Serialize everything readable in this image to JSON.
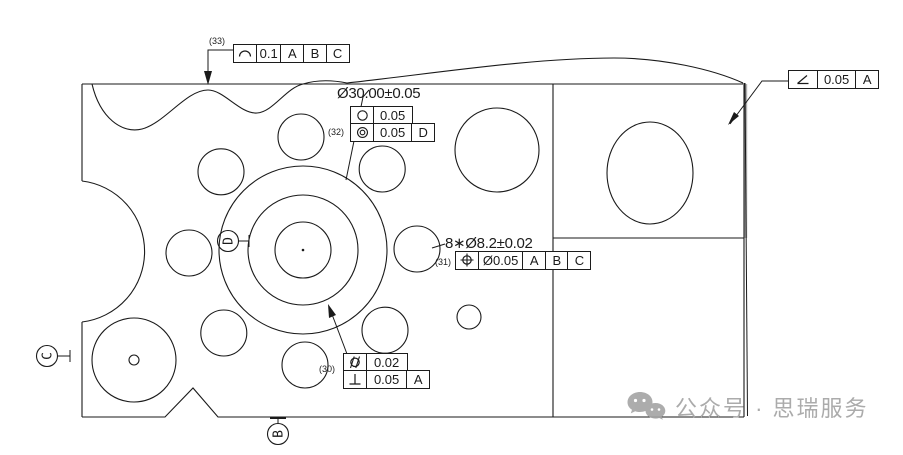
{
  "callouts": {
    "profile_line": {
      "label": "(33)",
      "symbol": "profile-of-a-line",
      "tolerance": "0.1",
      "datum1": "A",
      "datum2": "B",
      "datum3": "C"
    },
    "hub": {
      "label": "(32)",
      "dimension": "Ø30.00±0.05",
      "circularity": {
        "symbol": "circularity",
        "tolerance": "0.05"
      },
      "concentricity": {
        "symbol": "concentricity",
        "tolerance": "0.05",
        "datum": "D"
      }
    },
    "holes": {
      "label": "(31)",
      "dimension": "8∗Ø8.2±0.02",
      "symbol": "true-position",
      "tolerance": "Ø0.05",
      "datum1": "A",
      "datum2": "B",
      "datum3": "C"
    },
    "bore": {
      "label": "(30)",
      "cylindricity": {
        "symbol": "cylindricity",
        "tolerance": "0.02"
      },
      "perpendicularity": {
        "symbol": "perpendicularity",
        "tolerance": "0.05",
        "datum": "A"
      }
    },
    "edge": {
      "symbol": "angularity",
      "tolerance": "0.05",
      "datum": "A"
    }
  },
  "datums": {
    "left": "C",
    "bottom": "B",
    "center": "D"
  },
  "watermark": {
    "icon": "wechat-icon",
    "text": "公众号 · 思瑞服务"
  },
  "colors": {
    "line": "#1a1a1a",
    "edge_fill": "#b0b0b0",
    "watermark": "#ababab"
  },
  "geometry": {
    "hub": {
      "cx": 303,
      "cy": 250,
      "radii": [
        84,
        55,
        28
      ]
    },
    "bolt_circle": {
      "cx": 303,
      "cy": 251,
      "radius": 114,
      "hole_radius": 23,
      "hole_count": 8,
      "start_angle_deg": 1
    },
    "circles": [
      {
        "name": "large-hole-upper",
        "cx": 497,
        "cy": 150,
        "r": 42
      },
      {
        "name": "right-section-hole",
        "cx": 650,
        "cy": 173,
        "rx": 43,
        "ry": 51
      },
      {
        "name": "bottom-left-boss",
        "cx": 134,
        "cy": 360,
        "r": 42
      },
      {
        "name": "bottom-left-boss-center",
        "cx": 134,
        "cy": 360,
        "r": 5
      },
      {
        "name": "small-hole",
        "cx": 469,
        "cy": 317,
        "r": 12
      }
    ]
  }
}
